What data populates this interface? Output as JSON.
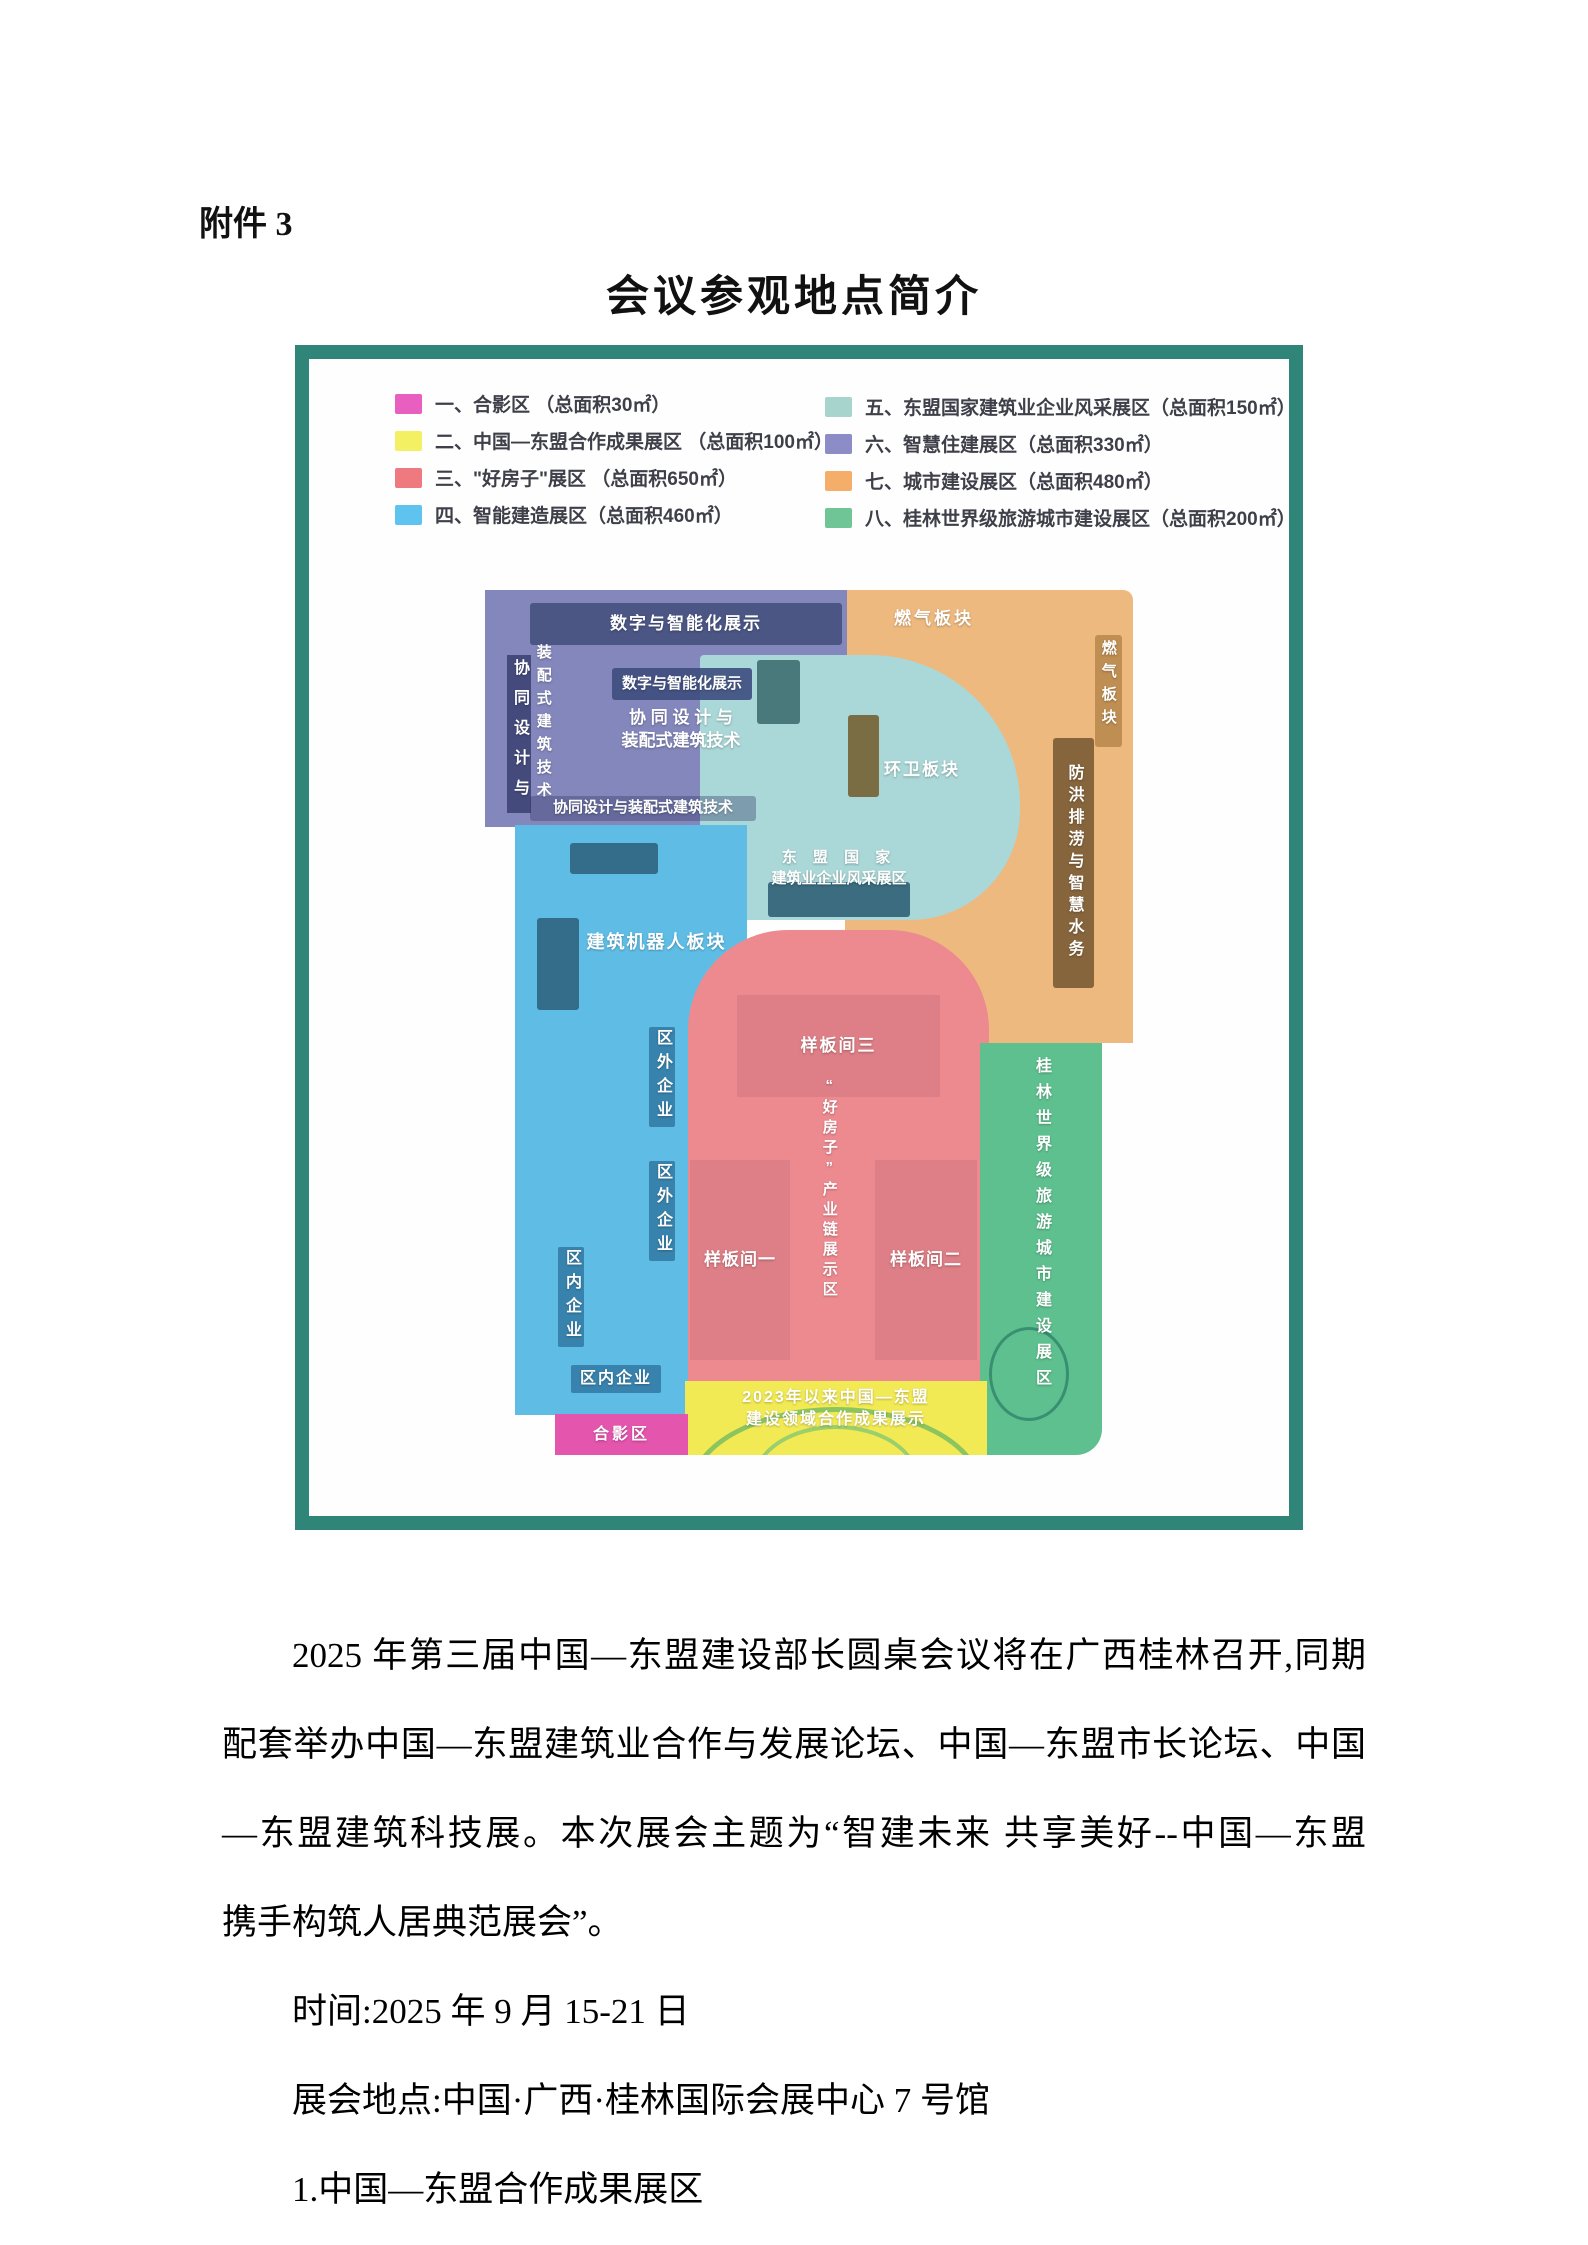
{
  "page": {
    "attachment_label": "附件 3",
    "title": "会议参观地点简介"
  },
  "legend": {
    "left": [
      {
        "text": "一、合影区 （总面积30㎡）",
        "color": "#e95fc0"
      },
      {
        "text": "二、中国—东盟合作成果展区 （总面积100㎡）",
        "color": "#f3f064"
      },
      {
        "text": "三、\"好房子\"展区 （总面积650㎡）",
        "color": "#ee7a80"
      },
      {
        "text": "四、智能建造展区（总面积460㎡）",
        "color": "#5ec3ee"
      }
    ],
    "right": [
      {
        "text": "五、东盟国家建筑业企业风采展区（总面积150㎡）",
        "color": "#a7d5cd"
      },
      {
        "text": "六、智慧住建展区（总面积330㎡）",
        "color": "#8c8cc6"
      },
      {
        "text": "七、城市建设展区（总面积480㎡）",
        "color": "#f5ae69"
      },
      {
        "text": "八、桂林世界级旅游城市建设展区（总面积200㎡）",
        "color": "#6fc595"
      }
    ]
  },
  "map": {
    "smart_housing": {
      "color": "#8487bb",
      "top_band": "数字与智能化展示",
      "left_col_1": "协同设计与",
      "left_col_2": "装配式建筑技术",
      "center_band": "数字与智能化展示",
      "center_line_1": "协 同 设 计 与",
      "center_line_2": "装配式建筑技术",
      "bottom_band": "协同设计与装配式建筑技术"
    },
    "city": {
      "color": "#eeb97e",
      "gas_top": "燃气板块",
      "gas_right": "燃气板块",
      "sanitation": "环卫板块",
      "flood": "防洪排涝与智慧水务"
    },
    "asean": {
      "color": "#aad7d7",
      "line_1": "东 盟 国 家",
      "line_2": "建筑业企业风采展区"
    },
    "smart_build": {
      "color": "#5fbde5",
      "robot": "建筑机器人板块",
      "outside_1": "区外企业",
      "outside_2": "区外企业",
      "inside_v": "区内企业",
      "inside_h": "区内企业"
    },
    "good_house": {
      "color": "#ec8a90",
      "room_color": "#de7e86",
      "room_3": "样板间三",
      "room_1": "样板间一",
      "room_2": "样板间二",
      "industry": "“好房子”产业链展示区"
    },
    "guilin": {
      "color": "#5ec08f",
      "label": "桂林世界级旅游城市建设展区"
    },
    "achievements": {
      "color": "#f2ea55",
      "line_1": "2023年以来中国—东盟",
      "line_2": "建设领域合作成果展示"
    },
    "photo_area": {
      "color": "#e455ae",
      "label": "合影区"
    }
  },
  "body": {
    "lines": [
      "2025 年第三届中国—东盟建设部长圆桌会议将在广西桂林召开,同期",
      "配套举办中国—东盟建筑业合作与发展论坛、中国—东盟市长论坛、中国",
      "—东盟建筑科技展。本次展会主题为“智建未来 共享美好--中国—东盟",
      "携手构筑人居典范展会”。",
      "时间:2025 年 9 月 15-21 日",
      "展会地点:中国·广西·桂林国际会展中心 7 号馆",
      "1.中国—东盟合作成果展区"
    ]
  }
}
